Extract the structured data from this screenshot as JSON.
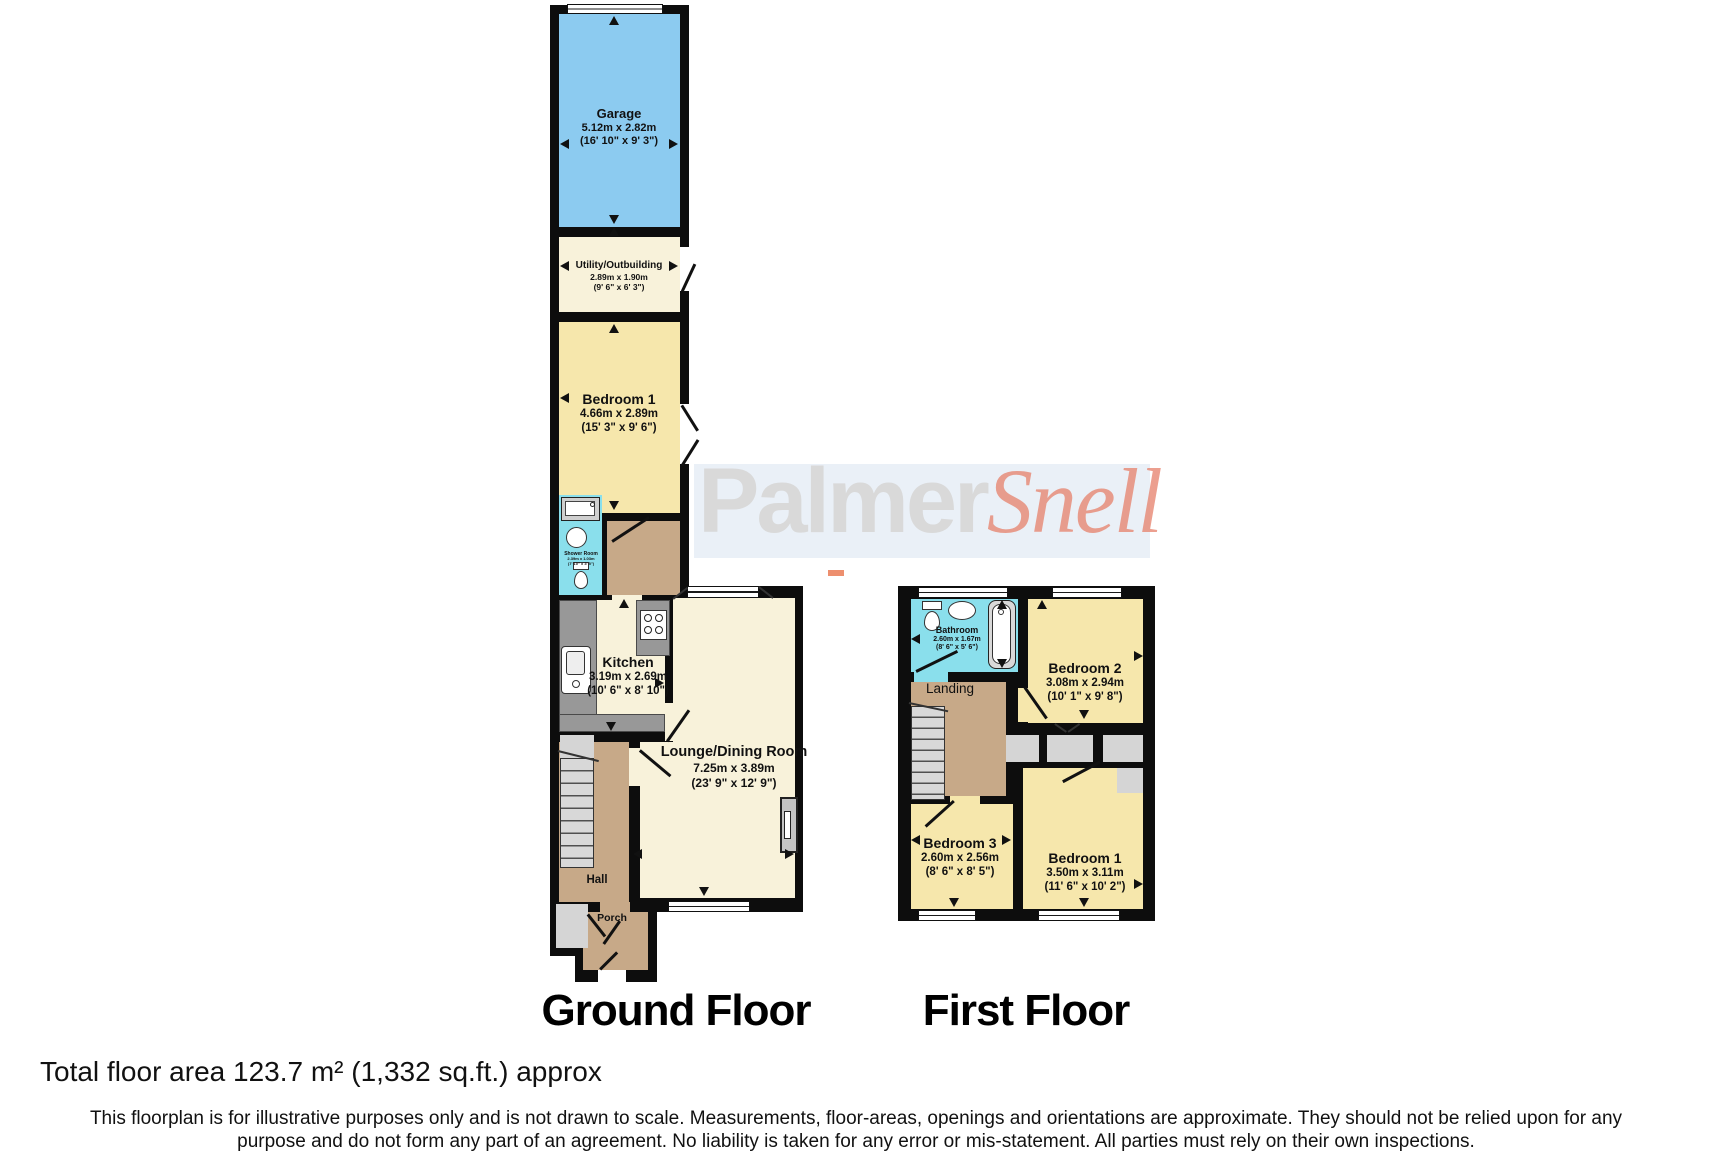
{
  "watermark": {
    "brand_bold": "Palmer",
    "brand_italic": "Snell"
  },
  "plans": {
    "ground": {
      "label": "Ground Floor"
    },
    "first": {
      "label": "First Floor"
    }
  },
  "rooms": {
    "garage": {
      "name": "Garage",
      "metric": "5.12m x 2.82m",
      "imperial": "(16' 10\" x 9' 3\")"
    },
    "utility": {
      "name": "Utility/Outbuilding",
      "metric": "2.89m x 1.90m",
      "imperial": "(9' 6\" x 6' 3\")"
    },
    "bedroom1_ground": {
      "name": "Bedroom 1",
      "metric": "4.66m x 2.89m",
      "imperial": "(15' 3\" x 9' 6\")"
    },
    "shower_room": {
      "name": "Shower Room",
      "metric": "2.39m x 1.03m",
      "imperial": "(7' 10\" x 3' 5\")"
    },
    "kitchen": {
      "name": "Kitchen",
      "metric": "3.19m x 2.69m",
      "imperial": "(10' 6\" x 8' 10\")"
    },
    "lounge": {
      "name": "Lounge/Dining Room",
      "metric": "7.25m x 3.89m",
      "imperial": "(23' 9\" x 12' 9\")"
    },
    "hall": {
      "name": "Hall"
    },
    "porch": {
      "name": "Porch"
    },
    "bathroom": {
      "name": "Bathroom",
      "metric": "2.60m x 1.67m",
      "imperial": "(8' 6\" x 5' 6\")"
    },
    "landing": {
      "name": "Landing"
    },
    "bedroom2": {
      "name": "Bedroom 2",
      "metric": "3.08m x 2.94m",
      "imperial": "(10' 1\" x 9' 8\")"
    },
    "bedroom3": {
      "name": "Bedroom 3",
      "metric": "2.60m x 2.56m",
      "imperial": "(8' 6\" x 8' 5\")"
    },
    "bedroom1_first": {
      "name": "Bedroom 1",
      "metric": "3.50m x 3.11m",
      "imperial": "(11' 6\" x 10' 2\")"
    }
  },
  "footer": {
    "total_area": "Total floor area 123.7 m² (1,332 sq.ft.) approx",
    "disclaimer_line1": "This floorplan is for illustrative purposes only and is not drawn to scale. Measurements, floor-areas, openings and orientations are approximate. They should not be relied upon for any",
    "disclaimer_line2": "purpose and do not form any part of an agreement. No liability is taken for any error or mis-statement. All parties must rely on their own inspections."
  },
  "colors": {
    "garage_fill": "#8CCBF0",
    "room_fill": "#F8F2DA",
    "bedroom_fill": "#F6E7AC",
    "hall_fill": "#C7A988",
    "wet_room_fill": "#8ADFEC",
    "wall": "#0D0D0D",
    "counter_gray": "#989898",
    "stairs_gray": "#D8D8D8",
    "watermark_gray": "#D9D9D9",
    "watermark_red": "#E6806A",
    "watermark_band": "#DCE6F2"
  }
}
